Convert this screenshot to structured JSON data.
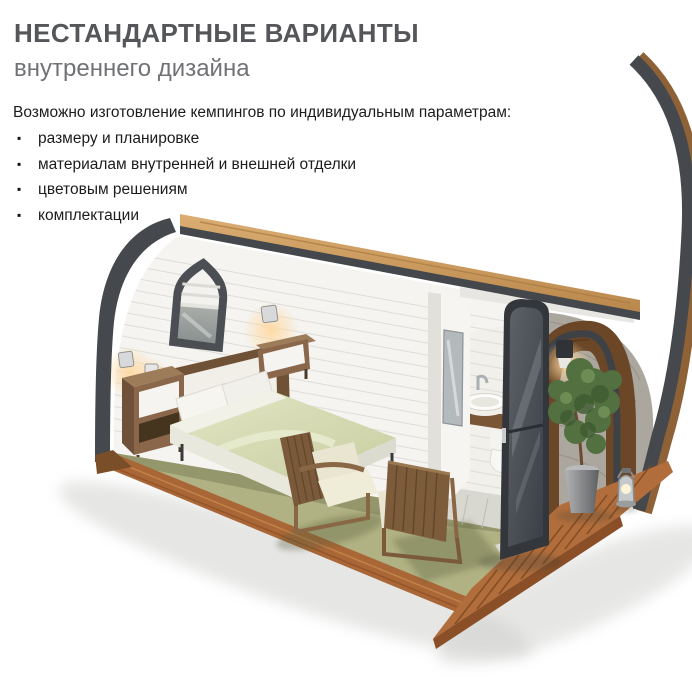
{
  "header": {
    "title": "НЕСТАНДАРТНЫЕ ВАРИАНТЫ",
    "subtitle": "внутреннего дизайна"
  },
  "features": {
    "intro": "Возможно изготовление кемпингов по индивидуальным параметрам:",
    "bullet_glyph": "▪",
    "items": [
      {
        "label": "размеру и планировке"
      },
      {
        "label": "материалам внутренней и внешней отделки"
      },
      {
        "label": "цветовым решениям"
      },
      {
        "label": "комплектации"
      }
    ]
  },
  "illustration": {
    "name": "camping-pod-interior-cutaway",
    "description": "3D cutaway render of an arch-shaped camping pod: bedroom with double bed, pointed-arch window with roman shade, two nightstands with wall lamps, two wooden cantilever chairs on olive carpet, bathroom with mirror, round vessel sink and toilet, dark walnut end wall with open glazed door, potted plant, lantern and wooden deck",
    "colors": {
      "shell_frame_gray": "#45484d",
      "roof_edge_wood": "#cda167",
      "wall_white": "#f5f4f1",
      "carpet_olive": "#b1b283",
      "carpet_olive_dark": "#8f9067",
      "floor_deck_wood": "#a96636",
      "end_wall_walnut": "#6b4728",
      "bedding_green": "#d6dab4",
      "furniture_wood": "#8a674a",
      "plant_green": "#527040",
      "title_gray": "#55565a",
      "subtitle_gray": "#717276",
      "body_text": "#1c1c1c"
    }
  }
}
